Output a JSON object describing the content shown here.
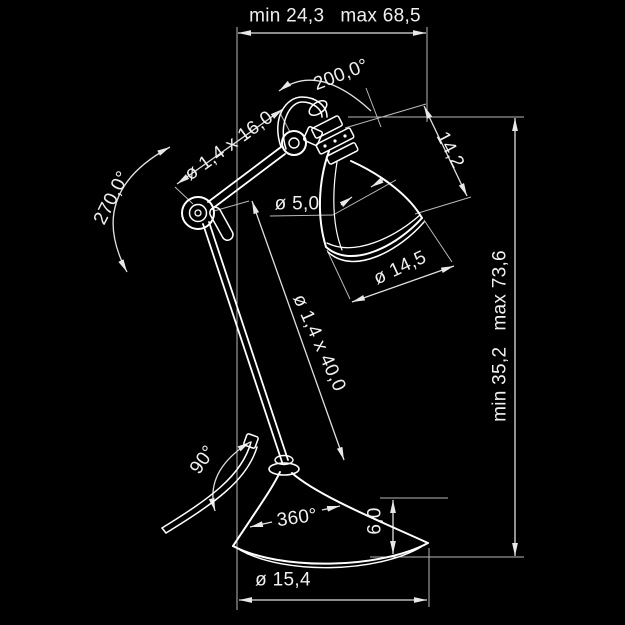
{
  "title": "Articulated desk lamp — dimensional technical drawing",
  "colors": {
    "background": "#000000",
    "lamp_line": "#ffffff",
    "dimension_line": "#d9d9d9",
    "text": "#f0f0f0"
  },
  "labels": {
    "reach_min": "min 24,3",
    "reach_max": "max 68,5",
    "head_angle": "200,0°",
    "shade_height": "14,2",
    "upper_arm_tube": "ø 1,4 x 16,0",
    "elbow_angle": "270,0°",
    "shade_neck_diameter": "ø 5,0",
    "shade_rim_diameter": "ø 14,5",
    "lower_arm_tube": "ø 1,4 x 40,0",
    "height_min": "min 35,2",
    "height_max": "max 73,6",
    "base_tilt_angle": "90°",
    "base_rotation_angle": "360°",
    "base_height": "6,0",
    "base_diameter": "ø 15,4"
  }
}
